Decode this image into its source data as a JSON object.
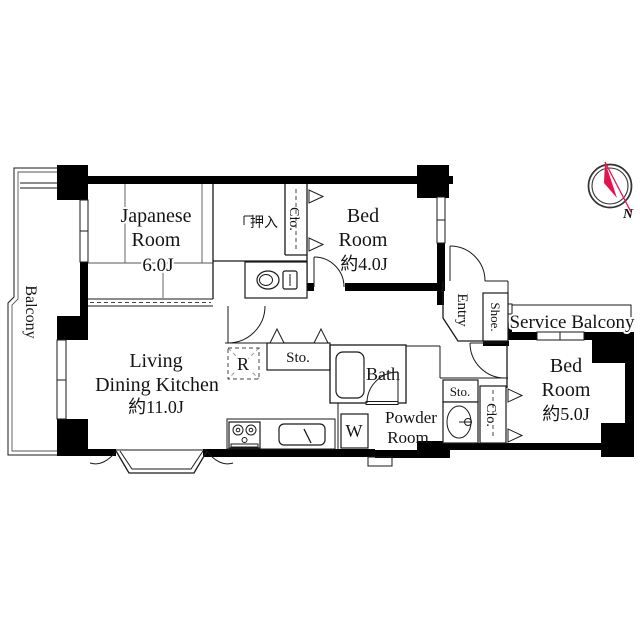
{
  "plan_title": "apartment-floor-plan",
  "rooms": {
    "balcony": {
      "label": "Balcony"
    },
    "japanese_room": {
      "name_line1": "Japanese",
      "name_line2": "Room",
      "size": "6.0J"
    },
    "oshiire": {
      "label": "押入"
    },
    "closet_bedroom1": {
      "label": "Clo."
    },
    "bedroom1": {
      "name_line1": "Bed",
      "name_line2": "Room",
      "size": "約4.0J"
    },
    "entry": {
      "label": "Entry"
    },
    "shoe_closet": {
      "label": "Shoe."
    },
    "service_balcony": {
      "label": "Service Balcony"
    },
    "bedroom2": {
      "name_line1": "Bed",
      "name_line2": "Room",
      "size": "約5.0J"
    },
    "closet_bedroom2": {
      "label": "Clo."
    },
    "storage_powder": {
      "label": "Sto."
    },
    "ldk": {
      "name_line1": "Living",
      "name_line2": "Dining Kitchen",
      "size": "約11.0J"
    },
    "refrigerator_space": {
      "label": "R"
    },
    "storage_hall": {
      "label": "Sto."
    },
    "bath": {
      "label": "Bath"
    },
    "washer_space": {
      "label": "W"
    },
    "powder_room": {
      "name_line1": "Powder",
      "name_line2": "Room"
    }
  },
  "compass": {
    "north_label": "N"
  },
  "colors": {
    "wall": "#000000",
    "compass_red": "#e3134e",
    "background": "#ffffff"
  }
}
